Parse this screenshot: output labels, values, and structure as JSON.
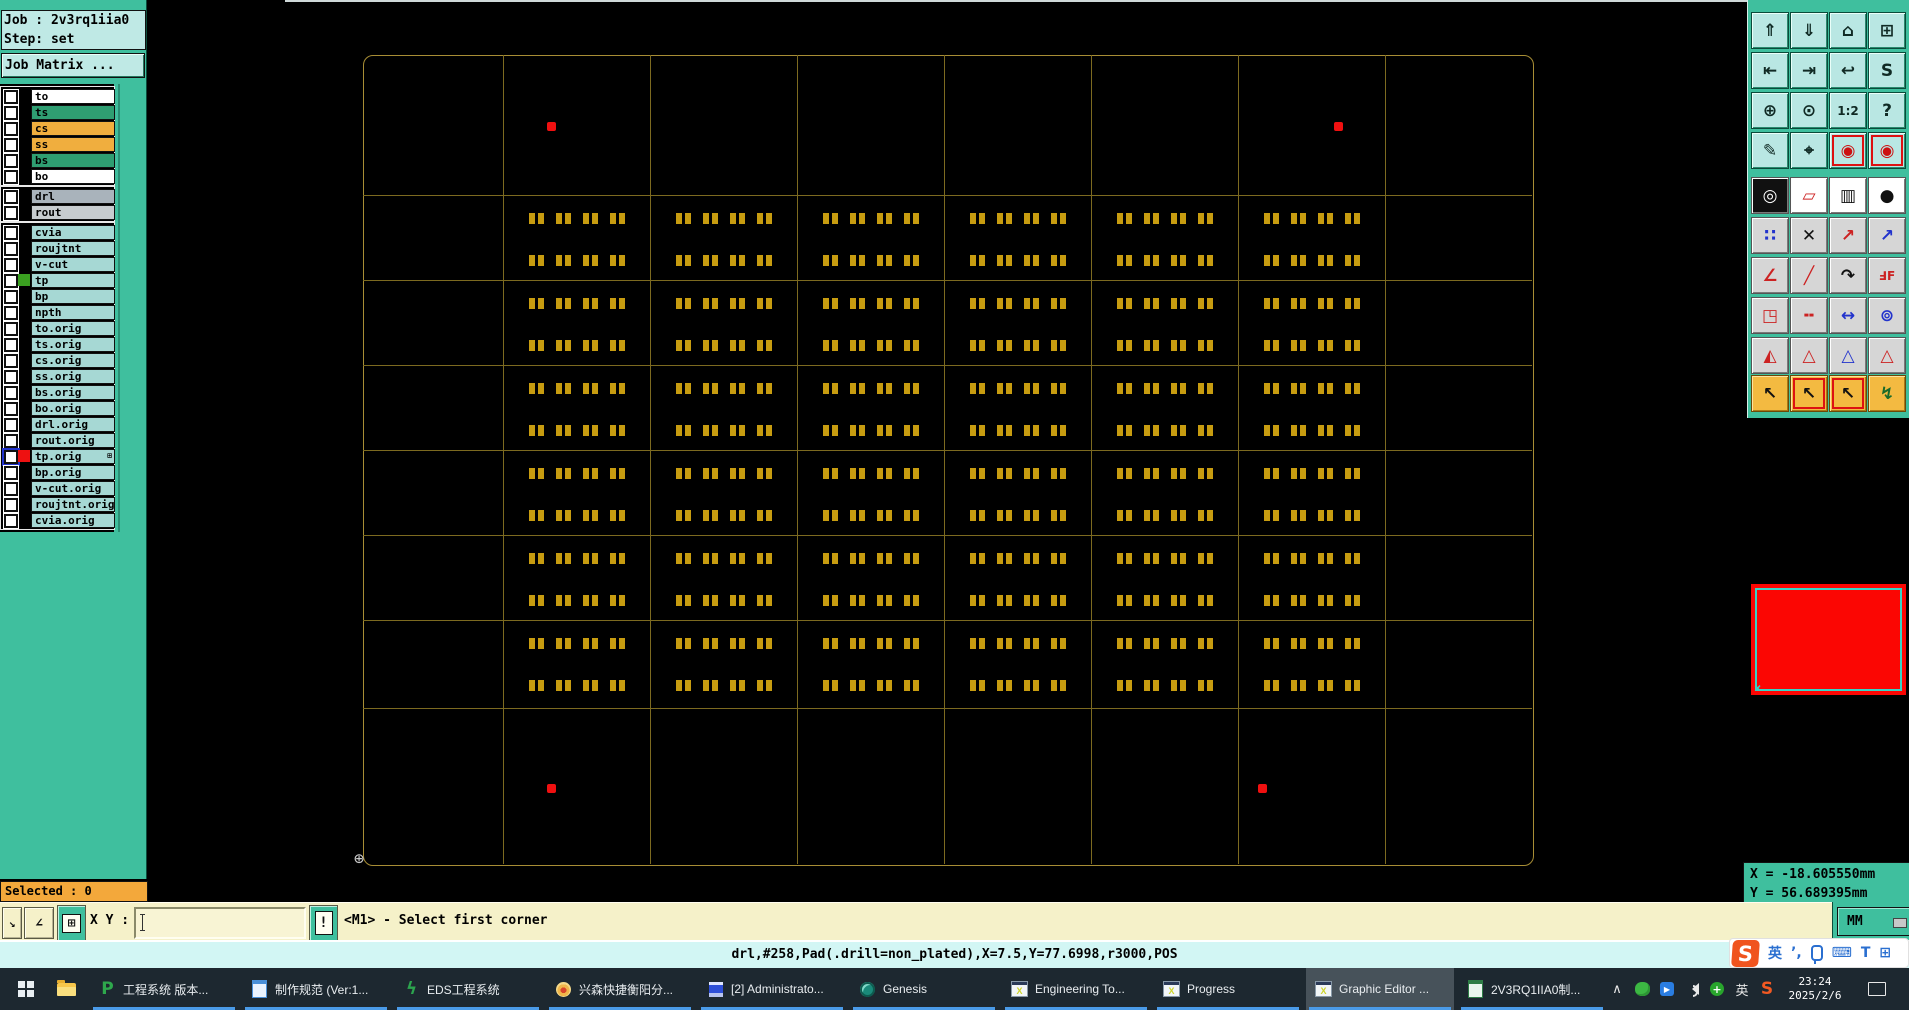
{
  "job_panel": {
    "job_label": "Job : 2v3rq1iia0",
    "step_label": "Step: set",
    "matrix_button": "Job Matrix ..."
  },
  "layers": {
    "row_pitch": 16,
    "groups": [
      {
        "top": 86,
        "items": [
          {
            "name": "to",
            "color": "#ffffff"
          },
          {
            "name": "ts",
            "color": "#2f9e72"
          },
          {
            "name": "cs",
            "color": "#f0ae3e"
          },
          {
            "name": "ss",
            "color": "#f0ae3e"
          },
          {
            "name": "bs",
            "color": "#2f9e72"
          },
          {
            "name": "bo",
            "color": "#ffffff"
          }
        ]
      },
      {
        "top": 186,
        "items": [
          {
            "name": "drl",
            "color": "#a9b3bb"
          },
          {
            "name": "rout",
            "color": "#c7cccf"
          }
        ]
      },
      {
        "top": 222,
        "items": [
          {
            "name": "cvia",
            "color": "#a6d8d4"
          },
          {
            "name": "roujtnt",
            "color": "#a6d8d4"
          },
          {
            "name": "v-cut",
            "color": "#a6d8d4"
          },
          {
            "name": "tp",
            "color": "#a6d8d4",
            "swatch": "#3aa020"
          },
          {
            "name": "bp",
            "color": "#a6d8d4"
          },
          {
            "name": "npth",
            "color": "#a6d8d4"
          },
          {
            "name": "to.orig",
            "color": "#a6d8d4"
          },
          {
            "name": "ts.orig",
            "color": "#a6d8d4"
          },
          {
            "name": "cs.orig",
            "color": "#a6d8d4"
          },
          {
            "name": "ss.orig",
            "color": "#a6d8d4"
          },
          {
            "name": "bs.orig",
            "color": "#a6d8d4"
          },
          {
            "name": "bo.orig",
            "color": "#a6d8d4"
          },
          {
            "name": "drl.orig",
            "color": "#a6d8d4"
          },
          {
            "name": "rout.orig",
            "color": "#a6d8d4"
          },
          {
            "name": "tp.orig",
            "color": "#a6d8d4",
            "swatch": "#ee1111",
            "active": true,
            "badge": "⊞"
          },
          {
            "name": "bp.orig",
            "color": "#a6d8d4"
          },
          {
            "name": "v-cut.orig",
            "color": "#a6d8d4"
          },
          {
            "name": "roujtnt.orig",
            "color": "#a6d8d4"
          },
          {
            "name": "cvia.orig",
            "color": "#a6d8d4"
          }
        ]
      }
    ]
  },
  "canvas": {
    "panel": {
      "left": 363,
      "top": 55,
      "right": 1532,
      "bottom": 864
    },
    "col_edges": [
      363,
      503,
      650,
      797,
      944,
      1091,
      1238,
      1385,
      1532
    ],
    "row_edges": [
      55,
      195,
      280,
      365,
      450,
      535,
      620,
      708,
      864
    ],
    "pad": {
      "color": "#c79c10",
      "cluster_offsets": [
        26,
        53,
        80,
        107
      ],
      "row_offsets": [
        18,
        60
      ],
      "band_first": 1,
      "band_last": 6,
      "col_first": 1,
      "col_last": 6
    },
    "fiducials": [
      [
        547,
        122
      ],
      [
        1334,
        122
      ],
      [
        547,
        784
      ],
      [
        1258,
        784
      ]
    ],
    "origin_glyph": "⊕"
  },
  "toolbar": {
    "col_x": [
      1751,
      1790,
      1829,
      1868
    ],
    "sections": [
      {
        "style": "s1",
        "top": 12,
        "pitch": 40,
        "rows": [
          [
            {
              "n": "zoom-area-button",
              "g": "⇑"
            },
            {
              "n": "zoom-screen-button",
              "g": "⇓"
            },
            {
              "n": "home-view-button",
              "g": "⌂"
            },
            {
              "n": "tile-xy-button",
              "g": "⊞"
            }
          ],
          [
            {
              "n": "pan-left-button",
              "g": "⇤"
            },
            {
              "n": "pan-right-button",
              "g": "⇥"
            },
            {
              "n": "previous-view-button",
              "g": "↩"
            },
            {
              "n": "serpentine-button",
              "g": "S"
            }
          ],
          [
            {
              "n": "zoom-in-button",
              "g": "⊕"
            },
            {
              "n": "zoom-center-button",
              "g": "⊙"
            },
            {
              "n": "zoom-1-2-button",
              "g": "1:2",
              "small": true
            },
            {
              "n": "help-button",
              "g": "?"
            }
          ],
          [
            {
              "n": "setup-tools-button",
              "g": "✎"
            },
            {
              "n": "origin-probe-button",
              "g": "⌖"
            },
            {
              "n": "highlight-net-a-button",
              "g": "◉",
              "fg": "#cc1111",
              "frame": true
            },
            {
              "n": "highlight-net-b-button",
              "g": "◉",
              "fg": "#cc1111",
              "frame": true
            }
          ]
        ]
      },
      {
        "style": "s2",
        "top": 177,
        "pitch": 40,
        "rows": [
          [
            {
              "n": "invert-display-button",
              "g": "◎",
              "bg": "#111",
              "fg": "#fff"
            },
            {
              "n": "reshape-button",
              "g": "▱",
              "fg": "#cc2222",
              "bg": "#fff"
            },
            {
              "n": "measure-ruler-button",
              "g": "▥",
              "bg": "#fff"
            },
            {
              "n": "pad-filter-button",
              "g": "●",
              "bg": "#fff"
            }
          ],
          [
            {
              "n": "connectivity-button",
              "g": "∷",
              "fg": "#2233cc"
            },
            {
              "n": "delete-object-button",
              "g": "✕"
            },
            {
              "n": "move-object-button",
              "g": "↗",
              "fg": "#cc2222"
            },
            {
              "n": "copy-object-button",
              "g": "↗",
              "fg": "#2233cc"
            }
          ],
          [
            {
              "n": "measure-angle-button",
              "g": "∠",
              "fg": "#cc2222"
            },
            {
              "n": "measure-slope-button",
              "g": "╱",
              "fg": "#cc2222"
            },
            {
              "n": "rotate-object-button",
              "g": "↷"
            },
            {
              "n": "mirror-object-button",
              "g": "ℲF",
              "fg": "#cc2222",
              "small": true
            }
          ],
          [
            {
              "n": "transform-shape-button",
              "g": "◳",
              "fg": "#cc2222"
            },
            {
              "n": "break-segment-button",
              "g": "╍",
              "fg": "#cc2222"
            },
            {
              "n": "measure-gap-button",
              "g": "↔",
              "fg": "#2233cc"
            },
            {
              "n": "combine-shape-button",
              "g": "⊚",
              "fg": "#2233cc"
            }
          ],
          [
            {
              "n": "arrow-under-button",
              "g": "◭",
              "fg": "#cc2222"
            },
            {
              "n": "arrow-chevron-button",
              "g": "△",
              "fg": "#cc2222"
            },
            {
              "n": "arrow-gate-button",
              "g": "△",
              "fg": "#2233cc"
            },
            {
              "n": "arrow-cross-button",
              "g": "△",
              "fg": "#cc2222"
            }
          ]
        ]
      },
      {
        "style": "s3",
        "top": 375,
        "pitch": 40,
        "rows": [
          [
            {
              "n": "select-single-button",
              "g": "↖"
            },
            {
              "n": "select-window-button",
              "g": "↖",
              "frame": true
            },
            {
              "n": "select-polygon-button",
              "g": "↖",
              "frame": true
            },
            {
              "n": "select-path-button",
              "g": "↯",
              "fg": "#1a6a2a"
            }
          ]
        ]
      }
    ]
  },
  "readout": {
    "x_label": "X = -18.605550mm",
    "y_label": "Y = 56.689395mm",
    "unit_button": "MM"
  },
  "status": {
    "selected_label": "Selected : 0",
    "xy_label": "X Y :",
    "xy_value": "",
    "resize_glyph": "↘",
    "angle_glyph": "∠",
    "grid_glyph": "⊞",
    "alert_glyph": "!",
    "prompt": "<M1> - Select first corner",
    "info_line": "drl,#258,Pad(.drill=non_plated),X=7.5,Y=77.6998,r3000,POS"
  },
  "ime_bar": {
    "logo": "S",
    "lang": "英",
    "punct": "’,",
    "keyboard_glyph": "⌨",
    "shirt_glyph": "T",
    "grid_glyph": "⊞"
  },
  "taskbar": {
    "apps": [
      {
        "icon": "greenp",
        "label": "工程系统  版本..."
      },
      {
        "icon": "bluedoc",
        "label": "制作规范 (Ver:1..."
      },
      {
        "icon": "eds",
        "label": "EDS工程系统"
      },
      {
        "icon": "shell",
        "label": "兴森快捷衡阳分..."
      },
      {
        "icon": "floppy",
        "label": "[2] Administrato..."
      },
      {
        "icon": "genesis",
        "label": "Genesis"
      },
      {
        "icon": "winx",
        "label": "Engineering To..."
      },
      {
        "icon": "winx",
        "label": "Progress"
      },
      {
        "icon": "winx",
        "label": "Graphic Editor ...",
        "active": true
      },
      {
        "icon": "excel",
        "label": "2V3RQ1IIA0制..."
      }
    ],
    "tray_lang": "英",
    "tray_sogou": "S",
    "clock": {
      "time": "23:24",
      "date": "2025/2/6"
    }
  }
}
